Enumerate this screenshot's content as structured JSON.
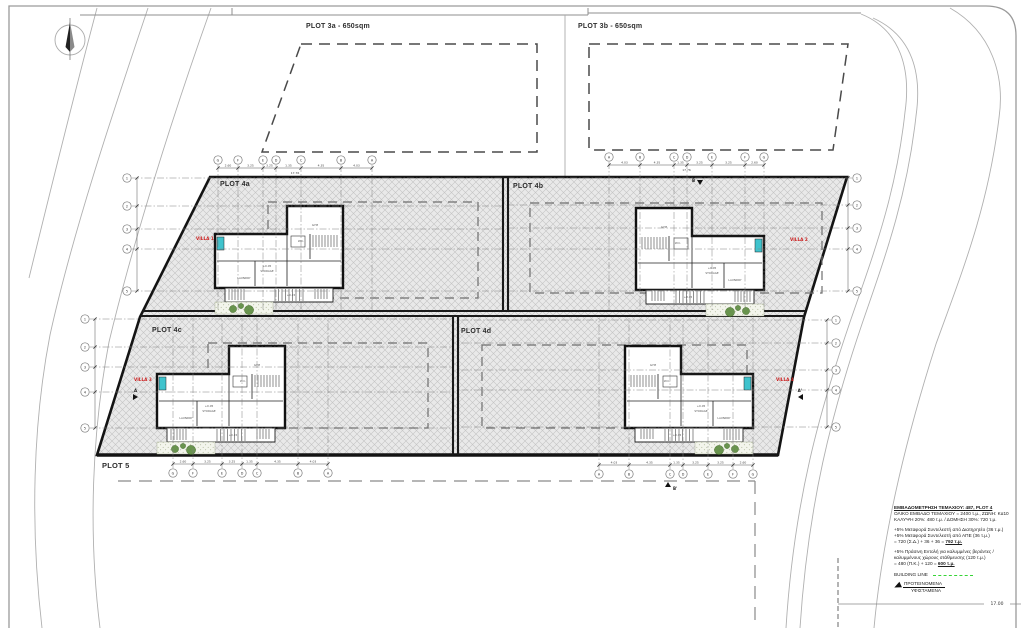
{
  "plots": {
    "p3a": "PLOT 3a - 650sqm",
    "p3b": "PLOT 3b - 650sqm",
    "p4a": "PLOT 4a",
    "p4b": "PLOT 4b",
    "p4c": "PLOT 4c",
    "p4d": "PLOT 4d",
    "p5": "PLOT 5"
  },
  "villas": [
    {
      "label": "VILLA 1",
      "tx": 215,
      "ty": 206,
      "mirror": false,
      "lx": 196,
      "ly": 240
    },
    {
      "label": "VILLA 2",
      "tx": 764,
      "ty": 208,
      "mirror": true,
      "lx": 790,
      "ly": 241
    },
    {
      "label": "VILLA 3",
      "tx": 157,
      "ty": 346,
      "mirror": false,
      "lx": 134,
      "ly": 381
    },
    {
      "label": "VILLA 4",
      "tx": 753,
      "ty": 346,
      "mirror": true,
      "lx": 776,
      "ly": 381
    }
  ],
  "villa_rooms": [
    {
      "t": "GYM",
      "dx": 100,
      "dy": 20
    },
    {
      "t": "W.C.",
      "dx": 86,
      "dy": 36
    },
    {
      "t": "+0.05",
      "dx": 52,
      "dy": 61
    },
    {
      "t": "STORAGE",
      "dx": 52,
      "dy": 66
    },
    {
      "t": "LAUNDRY",
      "dx": 29,
      "dy": 73
    },
    {
      "t": "+0.15",
      "dx": 76,
      "dy": 90
    }
  ],
  "grids": {
    "cols": [
      {
        "name": "villa1-top",
        "y": 160,
        "dim_y": 168,
        "total": "17.76",
        "total_y": 174,
        "line_to": 311,
        "x": [
          218,
          238,
          263,
          276,
          301,
          341,
          372
        ],
        "labels": [
          "G",
          "F",
          "E",
          "D",
          "C",
          "B",
          "A"
        ],
        "dims": [
          "2.60",
          "3.25",
          "3.25",
          "1.35",
          "4.35",
          "4.03"
        ]
      },
      {
        "name": "villa2-top",
        "y": 157,
        "dim_y": 165,
        "total": "17.76",
        "total_y": 171,
        "line_to": 311,
        "x": [
          609,
          640,
          674,
          687,
          712,
          745,
          764
        ],
        "labels": [
          "A",
          "B",
          "C",
          "D",
          "E",
          "F",
          "G"
        ],
        "dims": [
          "4.03",
          "4.35",
          "1.35",
          "3.25",
          "3.25",
          "2.60"
        ]
      },
      {
        "name": "villa3-bottom",
        "y": 473,
        "dim_y": 464,
        "total": "",
        "total_y": 0,
        "line_to": 318,
        "x": [
          173,
          193,
          222,
          242,
          257,
          298,
          328
        ],
        "labels": [
          "G",
          "F",
          "E",
          "D",
          "C",
          "B",
          "A"
        ],
        "dims": [
          "2.60",
          "3.25",
          "3.25",
          "1.35",
          "4.35",
          "4.03"
        ]
      },
      {
        "name": "villa4-bottom",
        "y": 474,
        "dim_y": 465,
        "total": "",
        "total_y": 0,
        "line_to": 318,
        "x": [
          599,
          629,
          670,
          683,
          708,
          733,
          753
        ],
        "labels": [
          "A",
          "B",
          "C",
          "D",
          "E",
          "F",
          "G"
        ],
        "dims": [
          "4.03",
          "4.35",
          "1.35",
          "3.25",
          "3.25",
          "2.60"
        ]
      }
    ],
    "rows": [
      {
        "name": "plot4a-left",
        "x": 127,
        "tick_x": 137,
        "line_to": 502,
        "y": [
          178,
          206,
          229,
          249,
          291
        ],
        "labels": [
          "1",
          "2",
          "3",
          "4",
          "5"
        ]
      },
      {
        "name": "plot4b-right",
        "x": 857,
        "tick_x": 848,
        "line_to": 509,
        "y": [
          178,
          205,
          228,
          249,
          291
        ],
        "labels": [
          "1",
          "2",
          "3",
          "4",
          "5"
        ]
      },
      {
        "name": "plot4c-left",
        "x": 85,
        "tick_x": 95,
        "line_to": 452,
        "y": [
          319,
          347,
          367,
          392,
          428
        ],
        "labels": [
          "1",
          "2",
          "3",
          "4",
          "5"
        ]
      },
      {
        "name": "plot4d-right",
        "x": 836,
        "tick_x": 827,
        "line_to": 459,
        "y": [
          320,
          343,
          370,
          390,
          427
        ],
        "labels": [
          "1",
          "2",
          "3",
          "4",
          "5"
        ]
      }
    ]
  },
  "sections": [
    {
      "label": "A",
      "x": 133,
      "y": 397,
      "dir": "right"
    },
    {
      "label": "A'",
      "x": 803,
      "y": 397,
      "dir": "left"
    },
    {
      "label": "B",
      "x": 700,
      "y": 180,
      "dir": "down"
    },
    {
      "label": "B'",
      "x": 668,
      "y": 487,
      "dir": "up"
    }
  ],
  "road_dim": "17.00",
  "legend": {
    "title_prefix": "ΕΜΒΑΔΟΜΕΤΡΗΣΗ ΤΕΜΑΧΙΟΥ: ",
    "title_emph": "487, PLOT 4",
    "line_area": "ΟΛΙΚΟ ΕΜΒΑΔΟ ΤΕΜΑΧΙΟΥ = 2400 τ.μ., ΖΩΝΗ: Κα10",
    "line_cover": "ΚΑΛΥΨΗ 20%: 480 τ.μ. / ΔΟΜΗΣΗ 30%: 720 τ.μ.",
    "line_tr1": "+5% Μεταφορά Συντελεστή από Διατηρητέο (36 τ.μ.)",
    "line_tr2": "+5% Μεταφορά Συντελεστή από ΑΠΕ (36 τ.μ.)",
    "line_tr_sum_prefix": "= 720 (Σ.Δ.) + 36 + 36 = ",
    "line_tr_sum_total": "792 τ.μ.",
    "line_green1": "+5% Πράσινη Εντολή για καλυμμένες βεράντες /",
    "line_green2": "καλυμμένους χώρους στάθμευσης (120 τ.μ.)",
    "line_green_sum_prefix": "= 480 (Π.Κ.) + 120 = ",
    "line_green_sum_total": "600 τ.μ.",
    "building_line": "BUILDING LINE",
    "proposed": "ΠΡΟΤΕΙΝΟΜΕΝΑ",
    "existing": "ΥΦΙΣΤΑΜΕΝΑ"
  },
  "colors": {
    "villa_label": "#cc2020",
    "building_line_green": "#35d435",
    "pool": "#3fc3cd",
    "plant": "#5b8a3e",
    "hatch_line": "#c4c4c4",
    "site_fill": "#e9e9e9"
  }
}
